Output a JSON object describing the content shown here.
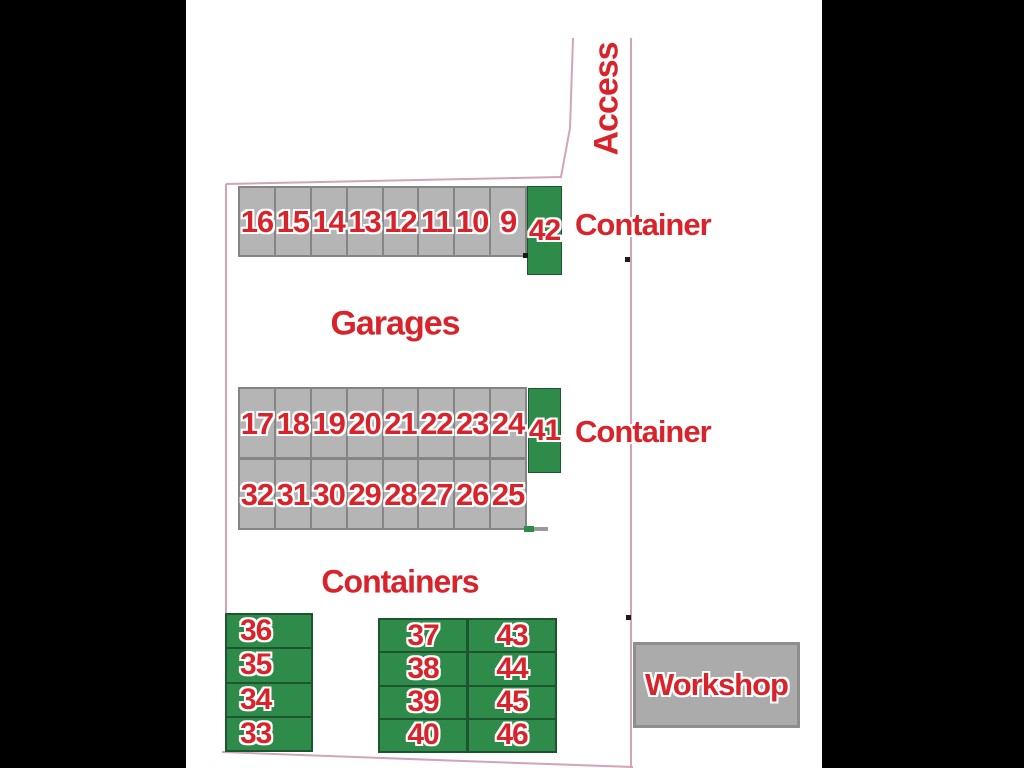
{
  "plan": {
    "access_label": "Access",
    "garages_heading": "Garages",
    "containers_heading": "Containers",
    "container_label_top": "Container",
    "container_label_mid": "Container",
    "workshop_label": "Workshop",
    "garage_strip": {
      "cells": [
        "16",
        "15",
        "14",
        "13",
        "12",
        "11",
        "10",
        "9"
      ]
    },
    "garage_block": {
      "top_row": [
        "17",
        "18",
        "19",
        "20",
        "21",
        "22",
        "23",
        "24"
      ],
      "bottom_row": [
        "32",
        "31",
        "30",
        "29",
        "28",
        "27",
        "26",
        "25"
      ]
    },
    "container_42": "42",
    "container_41": "41",
    "left_containers": [
      "36",
      "35",
      "34",
      "33"
    ],
    "middle_containers": {
      "col1": [
        "37",
        "38",
        "39",
        "40"
      ],
      "col2": [
        "43",
        "44",
        "45",
        "46"
      ]
    }
  },
  "colors": {
    "red": "#d9232b",
    "green": "#2e8b4a",
    "green_border": "#1c5530",
    "grey": "#b5b5b5",
    "cell_border": "#858585",
    "workshop": "#ababab",
    "pink": "#d2a4b8"
  }
}
